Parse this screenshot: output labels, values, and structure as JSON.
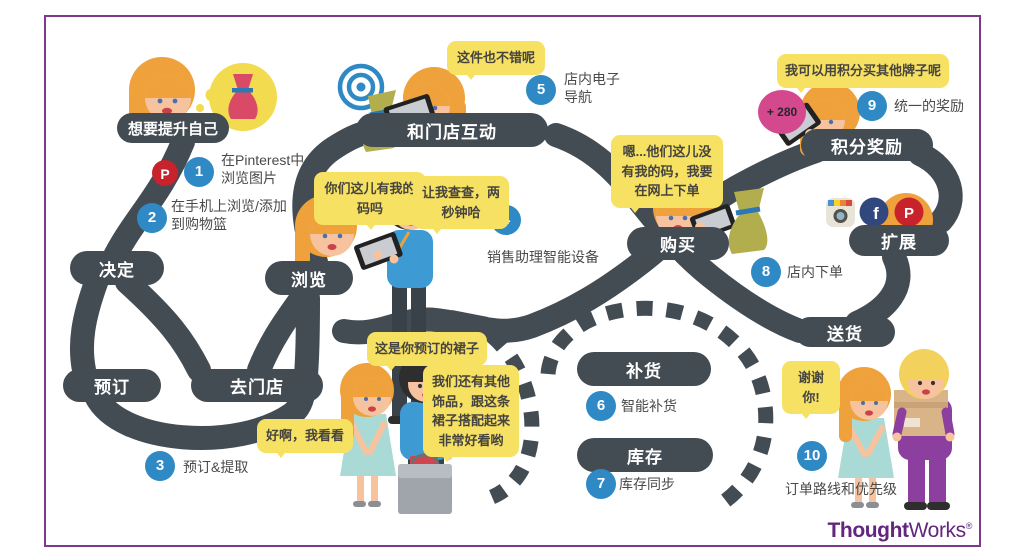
{
  "branding": {
    "logo_bold": "Thought",
    "logo_light": "Works",
    "reg": "®"
  },
  "stations": {
    "want_improve": "想要提升自己",
    "decide": "决定",
    "reserve": "预订",
    "go_store": "去门店",
    "browse": "浏览",
    "interact_store": "和门店互动",
    "purchase": "购买",
    "points_reward": "积分奖励",
    "expand": "扩展",
    "delivery": "送货",
    "replenish": "补货",
    "inventory": "库存"
  },
  "steps": [
    {
      "num": "1",
      "label": "在Pinterest中\n浏览图片"
    },
    {
      "num": "2",
      "label": "在手机上浏览/添加\n到购物篮"
    },
    {
      "num": "3",
      "label": "预订&提取"
    },
    {
      "num": "4",
      "label": "销售助理智能设备"
    },
    {
      "num": "5",
      "label": "店内电子\n导航"
    },
    {
      "num": "6",
      "label": "智能补货"
    },
    {
      "num": "7",
      "label": "库存同步"
    },
    {
      "num": "8",
      "label": "店内下单"
    },
    {
      "num": "9",
      "label": "统一的奖励"
    },
    {
      "num": "10",
      "label": "订单路线和优先级"
    }
  ],
  "bubbles": {
    "this_one": "这件也不错呢",
    "have_size": "你们这儿有我的\n码吗",
    "let_check": "让我查查，两\n秒钟哈",
    "no_size": "嗯...他们这儿没\n有我的码，我要\n在网上下单",
    "points_brands": "我可以用积分买其他牌子呢",
    "reserved_dress": "这是你预订的裙子",
    "accessories": "我们还有其他\n饰品，跟这条\n裙子搭配起来\n非常好看哟",
    "ok_look": "好啊，我看看",
    "thanks": "谢谢你!"
  },
  "badges": {
    "points_added": "+ 280"
  },
  "icons": {
    "pinterest_glyph": "P",
    "facebook_glyph": "f"
  },
  "colors": {
    "path_dark": "#434b53",
    "accent_blue": "#2e89c4",
    "bubble_yellow": "#f7e163",
    "brand_purple": "#63267f",
    "points_pink": "#d4498e",
    "dress_red": "#d84a66",
    "dress_olive": "#b2ae4e",
    "dress_teal": "#a9dad5",
    "shirt_purple": "#8c3f9e"
  }
}
